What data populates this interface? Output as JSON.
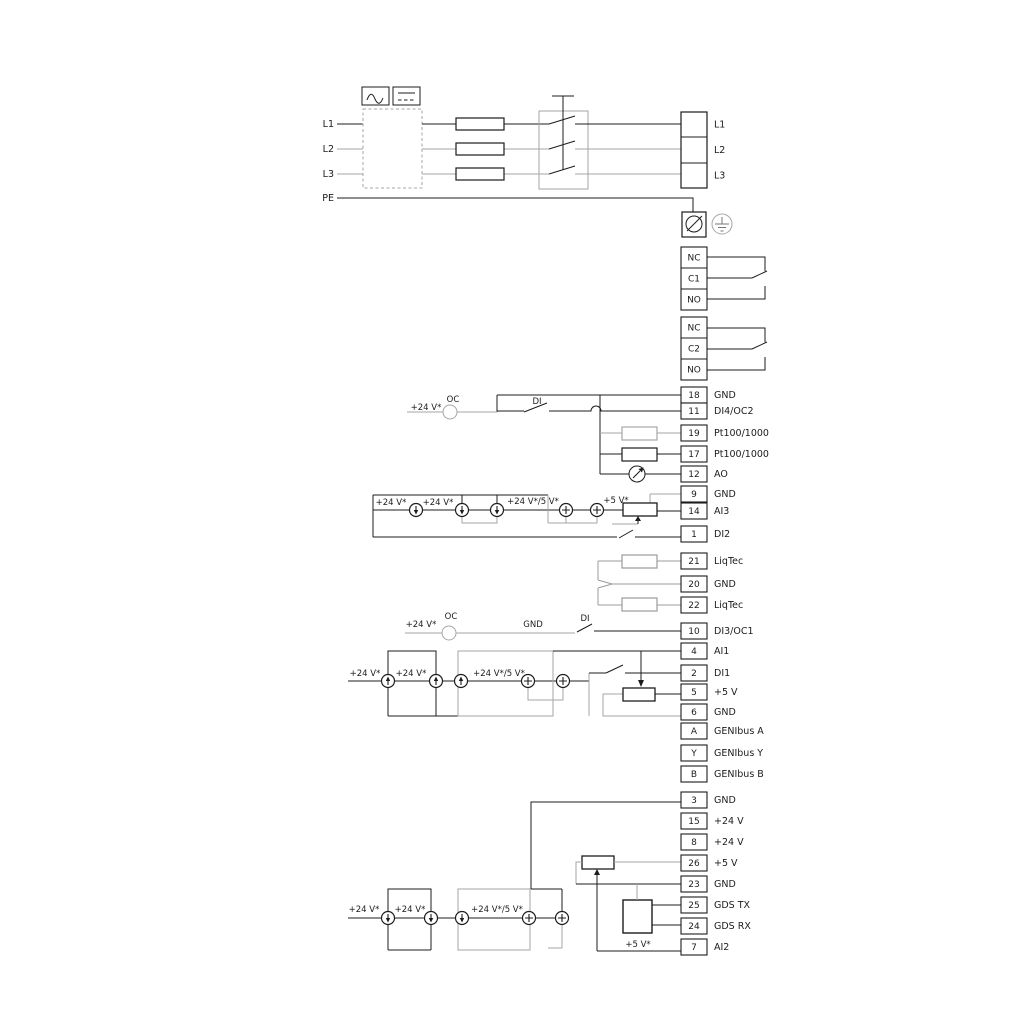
{
  "colors": {
    "line": "#1c1c1c",
    "muted": "#a6a6a6",
    "earth": "#777777"
  },
  "power": {
    "inputs": [
      "L1",
      "L2",
      "L3",
      "PE"
    ],
    "outputs": [
      "L1",
      "L2",
      "L3"
    ]
  },
  "relays": [
    {
      "cells": [
        "NC",
        "C1",
        "NO"
      ]
    },
    {
      "cells": [
        "NC",
        "C2",
        "NO"
      ]
    }
  ],
  "terminals": {
    "a": [
      {
        "n": "18",
        "t": "GND"
      },
      {
        "n": "11",
        "t": "DI4/OC2"
      },
      {
        "n": "19",
        "t": "Pt100/1000"
      },
      {
        "n": "17",
        "t": "Pt100/1000"
      },
      {
        "n": "12",
        "t": "AO"
      },
      {
        "n": "9",
        "t": "GND"
      },
      {
        "n": "14",
        "t": "AI3"
      },
      {
        "n": "1",
        "t": "DI2"
      }
    ],
    "b": [
      {
        "n": "21",
        "t": "LiqTec"
      },
      {
        "n": "20",
        "t": "GND"
      },
      {
        "n": "22",
        "t": "LiqTec"
      }
    ],
    "c": [
      {
        "n": "10",
        "t": "DI3/OC1"
      },
      {
        "n": "4",
        "t": "AI1"
      },
      {
        "n": "2",
        "t": "DI1"
      },
      {
        "n": "5",
        "t": "+5 V"
      },
      {
        "n": "6",
        "t": "GND"
      },
      {
        "n": "A",
        "t": "GENIbus A"
      },
      {
        "n": "Y",
        "t": "GENIbus Y"
      },
      {
        "n": "B",
        "t": "GENIbus B"
      }
    ],
    "d": [
      {
        "n": "3",
        "t": "GND"
      },
      {
        "n": "15",
        "t": "+24 V"
      },
      {
        "n": "8",
        "t": "+24 V"
      },
      {
        "n": "26",
        "t": "+5 V"
      },
      {
        "n": "23",
        "t": "GND"
      },
      {
        "n": "25",
        "t": "GDS TX"
      },
      {
        "n": "24",
        "t": "GDS RX"
      },
      {
        "n": "7",
        "t": "AI2"
      }
    ]
  },
  "annotations": {
    "di4_v24": "+24 V*",
    "di4_oc": "OC",
    "di4_di": "DI",
    "rowa_v24_1": "+24 V*",
    "rowa_v24_2": "+24 V*",
    "rowa_v245": "+24 V*/5 V*",
    "rowa_v5": "+5 V*",
    "di3_v24": "+24 V*",
    "di3_oc": "OC",
    "di3_gnd": "GND",
    "di3_di": "DI",
    "rowb_v24_1": "+24 V*",
    "rowb_v24_2": "+24 V*",
    "rowb_v245": "+24 V*/5 V*",
    "rowc_v24_1": "+24 V*",
    "rowc_v24_2": "+24 V*",
    "rowc_v245": "+24 V*/5 V*",
    "rowc_v5": "+5 V*"
  },
  "icons": [
    "ac-wave-icon",
    "dc-line-icon",
    "screw-terminal-icon",
    "earth-ground-icon"
  ]
}
